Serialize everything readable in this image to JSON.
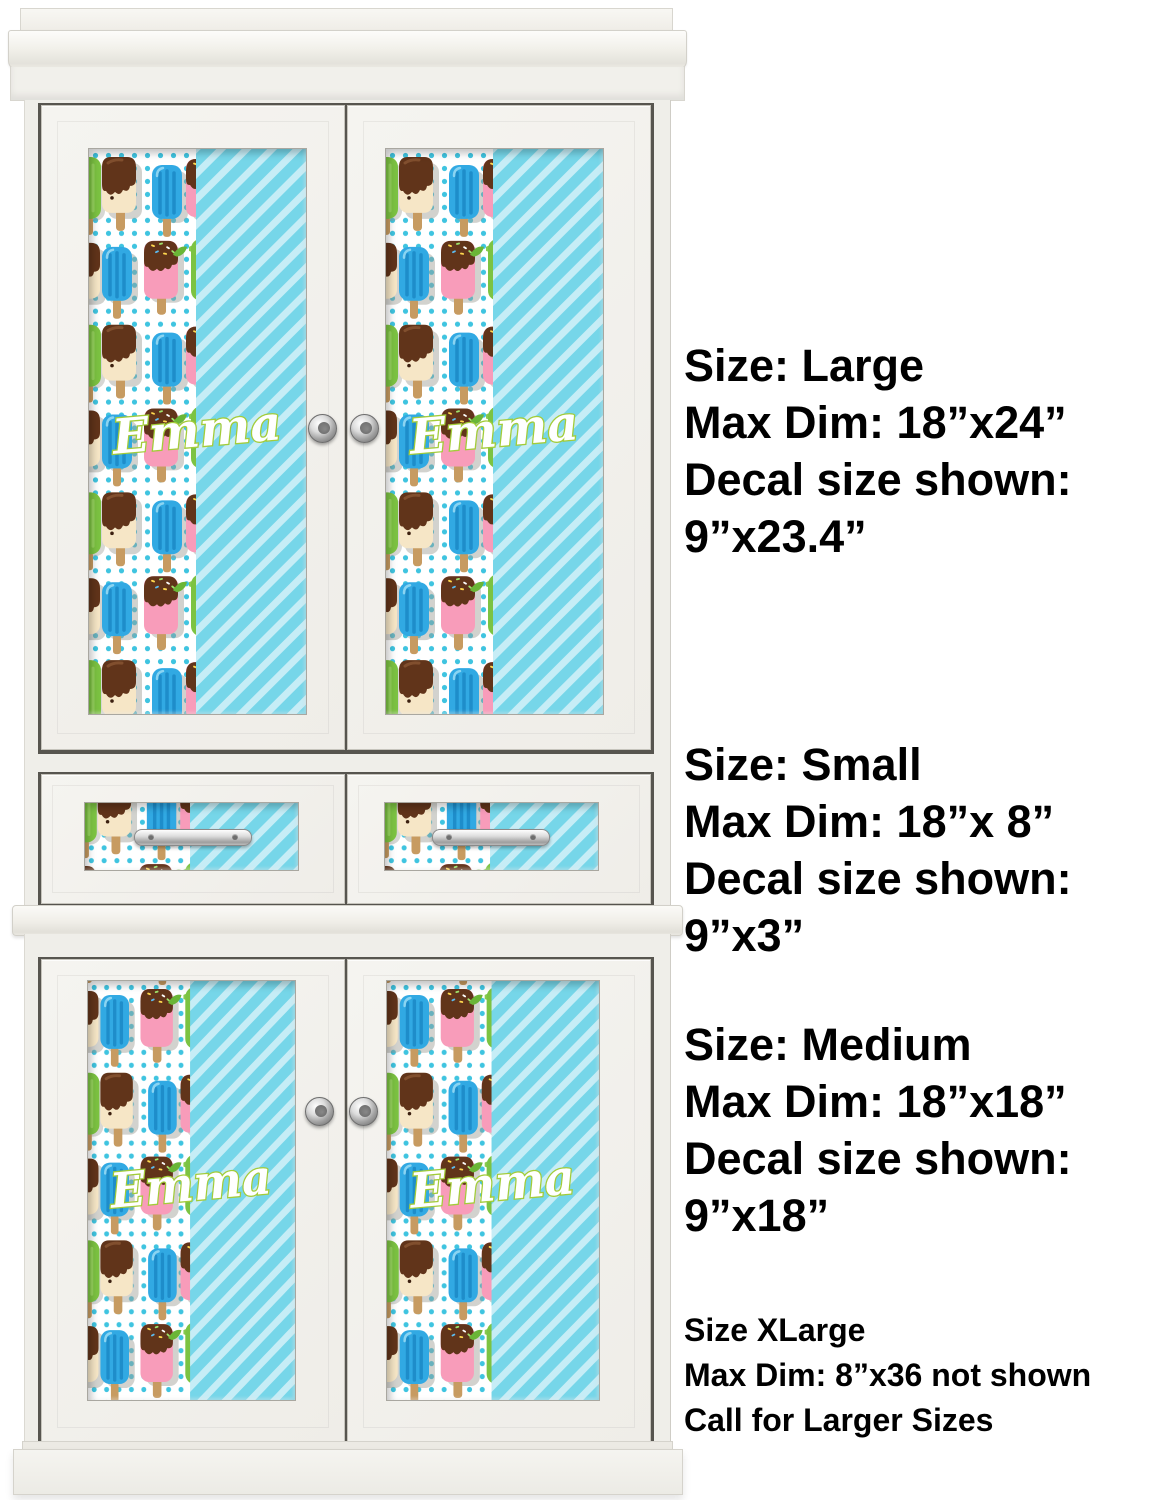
{
  "decal": {
    "name_text": "Emma",
    "colors": {
      "stripe_teal": "#76d6e9",
      "stripe_light": "#c6edf6",
      "polka_dot": "#3fc4e0",
      "name_fill": "#ffffff",
      "name_outline": "#a3cc39"
    },
    "pattern_icons": [
      "fudge-popsicle-icon",
      "blue-popsicle-icon",
      "pink-popsicle-icon",
      "green-popsicle-icon"
    ]
  },
  "size_blocks": [
    {
      "lines": [
        "Size: Large",
        "Max Dim: 18”x24”",
        "Decal size shown:",
        "9”x23.4”"
      ]
    },
    {
      "lines": [
        "Size: Small",
        "Max Dim: 18”x 8”",
        "Decal size shown:",
        "9”x3”"
      ]
    },
    {
      "lines": [
        "Size: Medium",
        "Max Dim: 18”x18”",
        "Decal size shown:",
        "9”x18”"
      ]
    },
    {
      "lines": [
        "Size XLarge",
        "Max Dim: 8”x36 not shown",
        "Call for Larger Sizes"
      ]
    }
  ]
}
